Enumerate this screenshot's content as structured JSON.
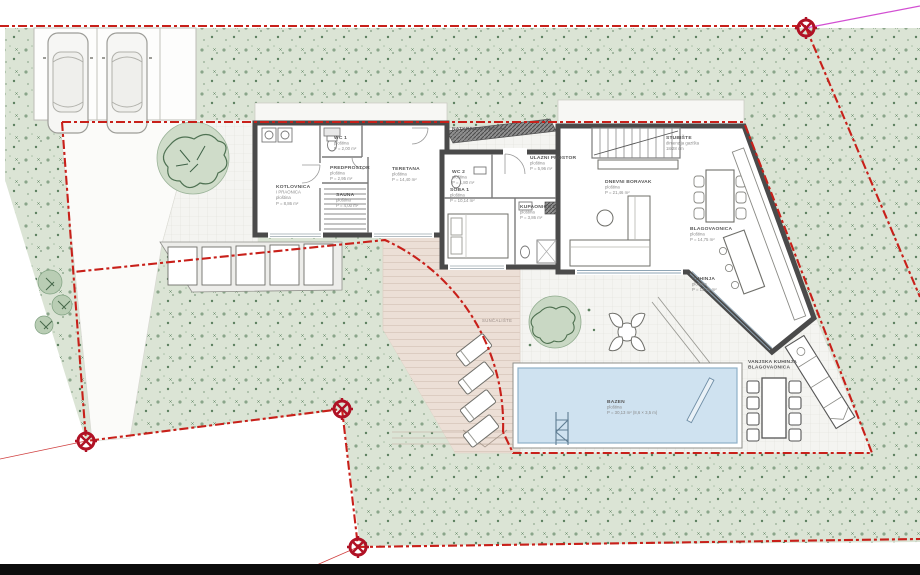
{
  "drawing": {
    "kind": "architectural site plan – ground floor",
    "area_word": "ploština"
  },
  "colors": {
    "boundary_red": "#c8201a",
    "survey_marker_red": "#b01225",
    "tie_line_magenta": "#d24fd2",
    "vegetation": "#dbe4d5",
    "vegetation_dot": "#6f8f6f",
    "paving": "#f4f4f1",
    "deck": "#ecdfd6",
    "wall_dark": "#4a4a4a",
    "pool_water": "#cfe2f0",
    "pool_edge": "#8fb0c8",
    "label_text": "#8a8a8a"
  },
  "site": {
    "markers": [
      {
        "x": 806,
        "y": 28
      },
      {
        "x": 86,
        "y": 441
      },
      {
        "x": 342,
        "y": 409
      },
      {
        "x": 358,
        "y": 547
      }
    ]
  },
  "labels": [
    {
      "kind": "room",
      "x": 276,
      "y": 188,
      "lines": [
        "KOTLOVNICA",
        "I PRAONICA",
        "ploština",
        "P = 8,86 m²"
      ]
    },
    {
      "kind": "room",
      "x": 334,
      "y": 139,
      "lines": [
        "WC 1",
        "ploština",
        "P = 2,00 m²"
      ]
    },
    {
      "kind": "room",
      "x": 330,
      "y": 169,
      "lines": [
        "PREDPROSTOR",
        "ploština",
        "P = 2,95 m²"
      ]
    },
    {
      "kind": "room",
      "x": 336,
      "y": 196,
      "lines": [
        "SAUNA",
        "ploština",
        "P = 4,00 m²"
      ]
    },
    {
      "kind": "room",
      "x": 392,
      "y": 170,
      "lines": [
        "TERETANA",
        "ploština",
        "P = 14,40 m²"
      ]
    },
    {
      "kind": "room",
      "x": 452,
      "y": 130,
      "lines": [
        "NATKRIVENI PROLAZ",
        "ploština",
        "P = 3,46 m²"
      ]
    },
    {
      "kind": "room",
      "x": 452,
      "y": 173,
      "lines": [
        "WC 2",
        "ploština",
        "P = 1,80 m²"
      ]
    },
    {
      "kind": "room",
      "x": 530,
      "y": 159,
      "lines": [
        "ULAZNI PROSTOR",
        "ploština",
        "P = 5,96 m²"
      ]
    },
    {
      "kind": "room",
      "x": 450,
      "y": 191,
      "lines": [
        "SOBA 1",
        "ploština",
        "P = 10,14 m²"
      ]
    },
    {
      "kind": "room",
      "x": 520,
      "y": 208,
      "lines": [
        "KUPAONICA 1",
        "ploština",
        "P = 3,86 m²"
      ]
    },
    {
      "kind": "room",
      "x": 605,
      "y": 183,
      "lines": [
        "DNEVNI BORAVAK",
        "ploština",
        "P = 21,46 m²"
      ]
    },
    {
      "kind": "room",
      "x": 666,
      "y": 139,
      "lines": [
        "STUBIŠTE",
        "dimenzija gazišta",
        "18/28 cm"
      ]
    },
    {
      "kind": "room",
      "x": 690,
      "y": 230,
      "lines": [
        "BLAGOVAONICA",
        "ploština",
        "P = 14,75 m²"
      ]
    },
    {
      "kind": "room",
      "x": 692,
      "y": 280,
      "lines": [
        "KUHINJA",
        "ploština",
        "P = 13,76 m²"
      ]
    },
    {
      "kind": "outdoor",
      "x": 482,
      "y": 322,
      "lines": [
        "SUNČALIŠTE"
      ]
    },
    {
      "kind": "room",
      "x": 607,
      "y": 403,
      "lines": [
        "BAZEN",
        "ploština",
        "P = 30,13 m² (8,6 × 3,5 m)"
      ]
    },
    {
      "kind": "room",
      "x": 748,
      "y": 363,
      "lines": [
        "VANJSKA KUHINJA",
        "BLAGOVAONICA"
      ]
    }
  ]
}
